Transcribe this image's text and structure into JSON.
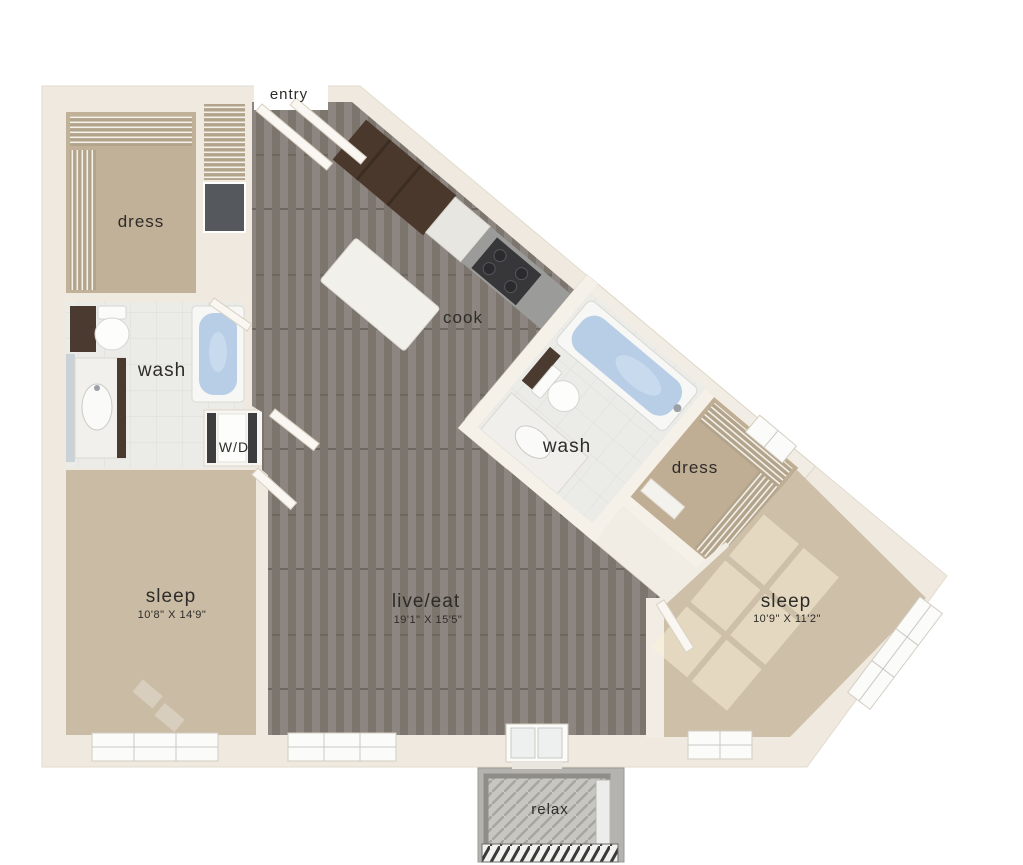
{
  "rooms": {
    "entry": {
      "label": "entry"
    },
    "dress_left": {
      "label": "dress"
    },
    "wash_left": {
      "label": "wash"
    },
    "laundry": {
      "label": "W/D"
    },
    "cook": {
      "label": "cook"
    },
    "wash_right": {
      "label": "wash"
    },
    "dress_right": {
      "label": "dress"
    },
    "sleep_left": {
      "label": "sleep",
      "dims": "10'8\" X 14'9\""
    },
    "live_eat": {
      "label": "live/eat",
      "dims": "19'1\" X 15'5\""
    },
    "sleep_right": {
      "label": "sleep",
      "dims": "10'9\" X 11'2\""
    },
    "relax": {
      "label": "relax"
    }
  },
  "colors": {
    "background": "#ffffff",
    "wall": "#efe9e0",
    "wall_inner": "#f6f1e8",
    "carpet_dark": "#c1b199",
    "carpet_light": "#cdbfa8",
    "wood_floor": "#868078",
    "tile": "#ebebe8",
    "tub_water": "#b8cee6",
    "cabinet_dark": "#4a382c",
    "counter_gray": "#9b9b99",
    "stove": "#37373a",
    "chute_gray": "#55585c",
    "balcony_concrete": "#b4b3af",
    "label_text": "#2e2c29"
  }
}
